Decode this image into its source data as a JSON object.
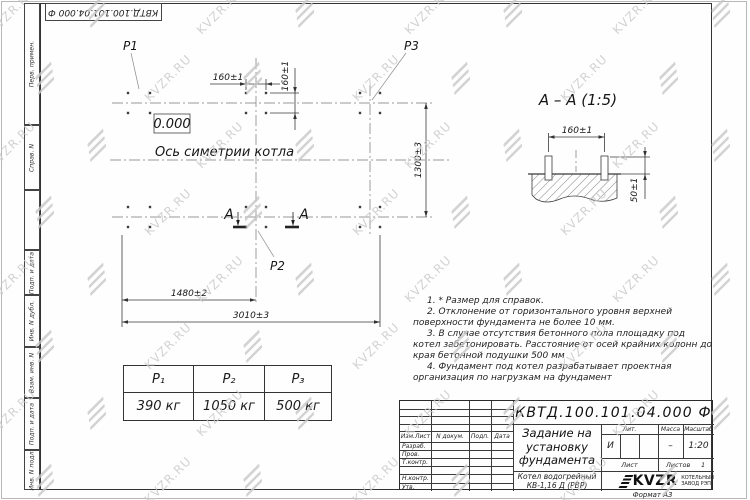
{
  "watermark": {
    "text": "KVZR.RU"
  },
  "frame": {
    "corner_designation": "КВТД.100.101.04.000 Ф",
    "margin_labels": [
      "Перв. примен.",
      "Справ. N",
      "Подп. и дата",
      "Инв. N дубл.",
      "Взам. инв. N",
      "Подп. и дата",
      "Инв. N подл."
    ],
    "format_label": "Формат А3"
  },
  "plan": {
    "p1": "P1",
    "p2": "P2",
    "p3": "P3",
    "elevation": "0.000",
    "axis_label": "Ось симетрии котла",
    "section_letter_left": "А",
    "section_letter_right": "А",
    "dim_bolt_spacing_h": "160±1",
    "dim_bolt_spacing_v": "160±1",
    "dim_width": "1300±3",
    "dim_left_to_center": "1480±2",
    "dim_total_length": "3010±3"
  },
  "section_view": {
    "title": "А – А  (1:5)",
    "dim_bolt_spacing": "160±1",
    "dim_bolt_height": "50±1"
  },
  "load_table": {
    "headers": [
      "P₁",
      "P₂",
      "P₃"
    ],
    "values": [
      "390 кг",
      "1050 кг",
      "500 кг"
    ]
  },
  "notes": [
    "1. * Размер для справок.",
    "2. Отклонение от горизонтального уровня верхней поверхности фундамента не более 10 мм.",
    "3. В случае отсутствия бетонного пола площадку под котел забетонировать. Расстояние от осей крайних колонн до края бетонной подушки 500 мм",
    "4. Фундамент под котел разрабатывает проектная организация по нагрузкам на фундамент"
  ],
  "title_block": {
    "designation": "КВТД.100.101.04.000 Ф",
    "doc_title": "Задание на\nустановку\nфундамента",
    "product": "Котел водогрейный\nКВ-1,16 Д  (РВР)",
    "rev_col1": "Изм.Лист",
    "rev_col2": "N докум.",
    "rev_col3": "Подп.",
    "rev_col4": "Дата",
    "sig_rows": [
      "Разраб.",
      "Пров.",
      "Т.контр.",
      "",
      "Н.контр.",
      "Утв."
    ],
    "lit_label": "Лит.",
    "mass_label": "Масса",
    "scale_label": "Масштаб",
    "lit_value": "И",
    "mass_value": "–",
    "scale_value": "1:20",
    "sheet_label": "Лист",
    "sheets_label": "Листов",
    "sheets_value": "1",
    "company_name": "KVZR",
    "company_text": "КОТЕЛЬНЫЙ\nЗАВОД РЭП"
  }
}
